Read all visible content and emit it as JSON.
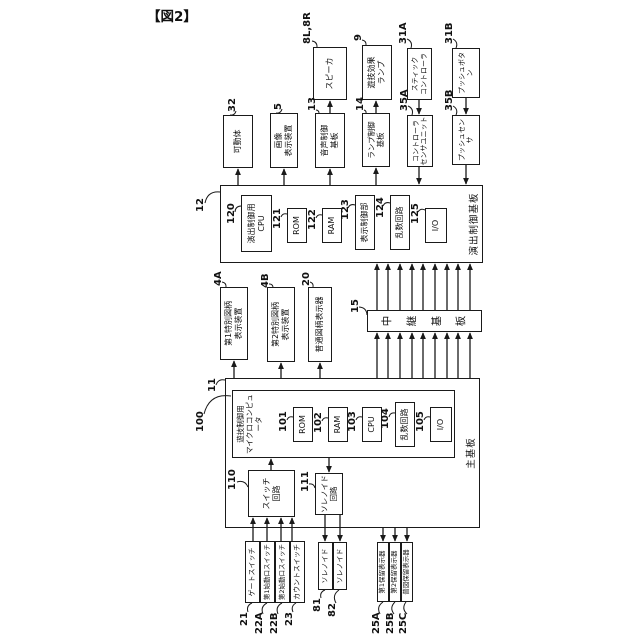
{
  "figure_label": "【図2】",
  "diagram": {
    "canvas": {
      "w": 630,
      "h": 292,
      "left": 195,
      "top": 8
    },
    "line_color": "#1a1a1a",
    "boxes": [
      {
        "id": "production-control-board",
        "x": 375,
        "y": 25,
        "w": 78,
        "h": 263,
        "lines": [
          "演出制御基板"
        ],
        "container": true,
        "label_pos": "bottom"
      },
      {
        "id": "main-board",
        "x": 110,
        "y": 30,
        "w": 150,
        "h": 255,
        "lines": [
          "主基板"
        ],
        "container": true,
        "label_pos": "bottom"
      },
      {
        "id": "game-control-micom",
        "x": 180,
        "y": 37,
        "w": 68,
        "h": 223,
        "lines": [
          "遊技制御用",
          "マイクロコンピュータ"
        ],
        "container": true,
        "label_pos": "top",
        "fs": 7.5
      },
      {
        "id": "effect-cpu-120",
        "x": 386,
        "y": 46,
        "w": 57,
        "h": 31,
        "lines": [
          "演出制御用",
          "CPU"
        ]
      },
      {
        "id": "rom-121",
        "x": 395,
        "y": 92,
        "w": 35,
        "h": 20,
        "lines": [
          "ROM"
        ]
      },
      {
        "id": "ram-122",
        "x": 395,
        "y": 127,
        "w": 35,
        "h": 20,
        "lines": [
          "RAM"
        ]
      },
      {
        "id": "display-control-123",
        "x": 388,
        "y": 160,
        "w": 55,
        "h": 20,
        "lines": [
          "表示制御部"
        ]
      },
      {
        "id": "random-circuit-124",
        "x": 388,
        "y": 195,
        "w": 55,
        "h": 20,
        "lines": [
          "乱数回路"
        ]
      },
      {
        "id": "io-125",
        "x": 395,
        "y": 230,
        "w": 35,
        "h": 22,
        "lines": [
          "I/O"
        ]
      },
      {
        "id": "relay-board-15",
        "x": 306,
        "y": 172,
        "w": 22,
        "h": 115,
        "lines": [
          "中継基板"
        ],
        "vertical": true
      },
      {
        "id": "rom-101",
        "x": 196,
        "y": 98,
        "w": 35,
        "h": 20,
        "lines": [
          "ROM"
        ]
      },
      {
        "id": "ram-102",
        "x": 196,
        "y": 133,
        "w": 35,
        "h": 20,
        "lines": [
          "RAM"
        ]
      },
      {
        "id": "cpu-103",
        "x": 196,
        "y": 167,
        "w": 35,
        "h": 20,
        "lines": [
          "CPU"
        ]
      },
      {
        "id": "random-circuit-104",
        "x": 191,
        "y": 200,
        "w": 45,
        "h": 20,
        "lines": [
          "乱数回路"
        ]
      },
      {
        "id": "io-105",
        "x": 196,
        "y": 235,
        "w": 35,
        "h": 22,
        "lines": [
          "I/O"
        ]
      },
      {
        "id": "switch-circuit-110",
        "x": 121,
        "y": 53,
        "w": 47,
        "h": 47,
        "lines": [
          "スイッチ",
          "回路"
        ]
      },
      {
        "id": "solenoid-circuit-111",
        "x": 123,
        "y": 120,
        "w": 42,
        "h": 28,
        "lines": [
          "ソレノイド",
          "回路"
        ],
        "fs": 7.5
      },
      {
        "id": "movable-body-32",
        "x": 470,
        "y": 28,
        "w": 53,
        "h": 30,
        "lines": [
          "可動体"
        ]
      },
      {
        "id": "image-display-5",
        "x": 470,
        "y": 75,
        "w": 55,
        "h": 28,
        "lines": [
          "画像",
          "表示装置"
        ]
      },
      {
        "id": "sound-control-board-13",
        "x": 470,
        "y": 120,
        "w": 55,
        "h": 30,
        "lines": [
          "音声制御",
          "基板"
        ]
      },
      {
        "id": "lamp-control-board-14",
        "x": 471,
        "y": 167,
        "w": 54,
        "h": 28,
        "lines": [
          "ランプ制御",
          "基板"
        ],
        "fs": 7.5
      },
      {
        "id": "controller-sensor-unit-35a",
        "x": 471,
        "y": 212,
        "w": 52,
        "h": 26,
        "lines": [
          "コントローラ",
          "センサユニット"
        ],
        "fs": 7
      },
      {
        "id": "push-sensor-35b",
        "x": 473,
        "y": 257,
        "w": 50,
        "h": 28,
        "lines": [
          "プッシュセンサ"
        ],
        "fs": 7
      },
      {
        "id": "speaker-8",
        "x": 538,
        "y": 118,
        "w": 53,
        "h": 34,
        "lines": [
          "スピーカ"
        ]
      },
      {
        "id": "game-effect-lamp-9",
        "x": 538,
        "y": 167,
        "w": 55,
        "h": 30,
        "lines": [
          "遊技効果",
          "ランプ"
        ]
      },
      {
        "id": "stick-controller-31a",
        "x": 538,
        "y": 212,
        "w": 52,
        "h": 25,
        "lines": [
          "スティック",
          "コントローラ"
        ],
        "fs": 7
      },
      {
        "id": "push-button-31b",
        "x": 540,
        "y": 257,
        "w": 50,
        "h": 28,
        "lines": [
          "プッシュボタン"
        ],
        "fs": 7
      },
      {
        "id": "special-symbol-display-4a",
        "x": 278,
        "y": 25,
        "w": 73,
        "h": 28,
        "lines": [
          "第1特別図柄",
          "表示装置"
        ]
      },
      {
        "id": "special-symbol-display-4b",
        "x": 276,
        "y": 72,
        "w": 75,
        "h": 28,
        "lines": [
          "第2特別図柄",
          "表示装置"
        ]
      },
      {
        "id": "normal-symbol-display-20",
        "x": 276,
        "y": 113,
        "w": 75,
        "h": 24,
        "lines": [
          "普通図柄表示器"
        ]
      },
      {
        "id": "gate-switch-21",
        "x": 35,
        "y": 50,
        "w": 62,
        "h": 15,
        "lines": [
          "ゲートスイッチ"
        ],
        "fs": 7
      },
      {
        "id": "first-start-switch-22a",
        "x": 35,
        "y": 65,
        "w": 62,
        "h": 15,
        "lines": [
          "第1始動口スイッチ"
        ],
        "fs": 6.5
      },
      {
        "id": "second-start-switch-22b",
        "x": 35,
        "y": 80,
        "w": 62,
        "h": 15,
        "lines": [
          "第2始動口スイッチ"
        ],
        "fs": 6.5
      },
      {
        "id": "count-switch-23",
        "x": 35,
        "y": 95,
        "w": 62,
        "h": 15,
        "lines": [
          "カウントスイッチ"
        ],
        "fs": 7
      },
      {
        "id": "solenoid-81",
        "x": 48,
        "y": 123,
        "w": 48,
        "h": 15,
        "lines": [
          "ソレノイド"
        ],
        "fs": 7
      },
      {
        "id": "solenoid-82",
        "x": 48,
        "y": 138,
        "w": 48,
        "h": 14,
        "lines": [
          "ソレノイド"
        ],
        "fs": 7
      },
      {
        "id": "first-hold-display-25a",
        "x": 36,
        "y": 182,
        "w": 60,
        "h": 12,
        "lines": [
          "第1保留表示器"
        ],
        "fs": 6.5
      },
      {
        "id": "second-hold-display-25b",
        "x": 36,
        "y": 194,
        "w": 60,
        "h": 12,
        "lines": [
          "第2保留表示器"
        ],
        "fs": 6.5
      },
      {
        "id": "normal-hold-display-25c",
        "x": 36,
        "y": 206,
        "w": 60,
        "h": 12,
        "lines": [
          "普図保留表示器"
        ],
        "fs": 6.5
      }
    ],
    "labels": [
      {
        "t": "12",
        "x": 426,
        "y": 0,
        "lead": [
          435,
          10,
          446,
          25
        ]
      },
      {
        "t": "11",
        "x": 246,
        "y": 12,
        "lead": [
          253,
          21,
          258,
          30
        ]
      },
      {
        "t": "100",
        "x": 206,
        "y": 0,
        "lead": [
          224,
          9,
          242,
          36
        ]
      },
      {
        "t": "15",
        "x": 325,
        "y": 155,
        "lead": [
          331,
          164,
          323,
          172
        ]
      },
      {
        "t": "120",
        "x": 414,
        "y": 31,
        "lead": [
          426,
          40,
          432,
          46
        ]
      },
      {
        "t": "121",
        "x": 409,
        "y": 77,
        "lead": [
          421,
          86,
          424,
          92
        ]
      },
      {
        "t": "122",
        "x": 408,
        "y": 112,
        "lead": [
          420,
          121,
          423,
          127
        ]
      },
      {
        "t": "123",
        "x": 418,
        "y": 145,
        "lead": [
          430,
          153,
          433,
          160
        ]
      },
      {
        "t": "124",
        "x": 420,
        "y": 180,
        "lead": [
          432,
          188,
          435,
          195
        ]
      },
      {
        "t": "125",
        "x": 414,
        "y": 215,
        "lead": [
          426,
          223,
          428,
          230
        ]
      },
      {
        "t": "101",
        "x": 206,
        "y": 83,
        "lead": [
          218,
          92,
          221,
          98
        ]
      },
      {
        "t": "102",
        "x": 205,
        "y": 118,
        "lead": [
          217,
          127,
          220,
          133
        ]
      },
      {
        "t": "103",
        "x": 206,
        "y": 152,
        "lead": [
          218,
          161,
          221,
          167
        ]
      },
      {
        "t": "104",
        "x": 209,
        "y": 185,
        "lead": [
          221,
          194,
          225,
          200
        ]
      },
      {
        "t": "105",
        "x": 206,
        "y": 220,
        "lead": [
          218,
          229,
          221,
          235
        ]
      },
      {
        "t": "110",
        "x": 148,
        "y": 32,
        "lead": [
          156,
          42,
          151,
          53
        ]
      },
      {
        "t": "111",
        "x": 146,
        "y": 105,
        "lead": [
          154,
          114,
          150,
          120
        ]
      },
      {
        "t": "32",
        "x": 526,
        "y": 32,
        "lead": [
          527,
          41,
          523,
          35
        ]
      },
      {
        "t": "5",
        "x": 528,
        "y": 78,
        "lead": [
          529,
          87,
          525,
          81
        ]
      },
      {
        "t": "13",
        "x": 527,
        "y": 112,
        "lead": [
          528,
          121,
          525,
          124
        ]
      },
      {
        "t": "14",
        "x": 527,
        "y": 160,
        "lead": [
          528,
          169,
          525,
          171
        ]
      },
      {
        "t": "35A",
        "x": 527,
        "y": 204,
        "lead": [
          532,
          213,
          523,
          217
        ]
      },
      {
        "t": "35B",
        "x": 527,
        "y": 249,
        "lead": [
          532,
          258,
          523,
          261
        ]
      },
      {
        "t": "8L,8R",
        "x": 594,
        "y": 107,
        "lead": [
          597,
          117,
          591,
          122
        ]
      },
      {
        "t": "9",
        "x": 597,
        "y": 158,
        "lead": [
          598,
          167,
          593,
          171
        ]
      },
      {
        "t": "31A",
        "x": 594,
        "y": 203,
        "lead": [
          599,
          212,
          590,
          216
        ]
      },
      {
        "t": "31B",
        "x": 594,
        "y": 249,
        "lead": [
          599,
          258,
          590,
          261
        ]
      },
      {
        "t": "4A",
        "x": 352,
        "y": 18,
        "lead": [
          356,
          27,
          351,
          31
        ]
      },
      {
        "t": "4B",
        "x": 350,
        "y": 65,
        "lead": [
          354,
          74,
          351,
          78
        ]
      },
      {
        "t": "20",
        "x": 352,
        "y": 106,
        "lead": [
          356,
          115,
          351,
          118
        ]
      },
      {
        "t": "21",
        "x": 12,
        "y": 44,
        "lead": [
          26,
          53,
          35,
          57
        ]
      },
      {
        "t": "22A",
        "x": 4,
        "y": 59,
        "lead": [
          24,
          68,
          35,
          72
        ]
      },
      {
        "t": "22B",
        "x": 4,
        "y": 74,
        "lead": [
          24,
          83,
          35,
          87
        ]
      },
      {
        "t": "23",
        "x": 12,
        "y": 89,
        "lead": [
          26,
          98,
          35,
          101
        ]
      },
      {
        "t": "81",
        "x": 26,
        "y": 117,
        "lead": [
          40,
          126,
          48,
          130
        ]
      },
      {
        "t": "82",
        "x": 21,
        "y": 132,
        "lead": [
          35,
          141,
          48,
          144
        ]
      },
      {
        "t": "25A",
        "x": 4,
        "y": 176,
        "lead": [
          24,
          185,
          36,
          188
        ]
      },
      {
        "t": "25B",
        "x": 4,
        "y": 190,
        "lead": [
          24,
          199,
          36,
          200
        ]
      },
      {
        "t": "25C",
        "x": 4,
        "y": 203,
        "lead": [
          24,
          212,
          36,
          211
        ]
      }
    ],
    "arrows": [
      [
        453,
        43,
        469,
        43
      ],
      [
        453,
        89,
        469,
        89
      ],
      [
        453,
        135,
        469,
        135
      ],
      [
        453,
        181,
        470,
        181
      ],
      [
        525,
        135,
        537,
        135
      ],
      [
        525,
        181,
        537,
        181
      ],
      [
        538,
        224,
        524,
        224
      ],
      [
        471,
        224,
        454,
        224
      ],
      [
        540,
        271,
        524,
        271
      ],
      [
        473,
        271,
        454,
        271
      ],
      [
        260,
        39,
        277,
        39
      ],
      [
        260,
        86,
        275,
        86
      ],
      [
        260,
        125,
        275,
        125
      ],
      [
        260,
        182,
        305,
        182
      ],
      [
        328,
        182,
        374,
        182
      ],
      [
        260,
        193,
        305,
        193
      ],
      [
        328,
        193,
        374,
        193
      ],
      [
        260,
        205,
        305,
        205
      ],
      [
        328,
        205,
        374,
        205
      ],
      [
        260,
        217,
        305,
        217
      ],
      [
        328,
        217,
        374,
        217
      ],
      [
        260,
        228,
        305,
        228
      ],
      [
        328,
        228,
        374,
        228
      ],
      [
        260,
        240,
        305,
        240
      ],
      [
        328,
        240,
        374,
        240
      ],
      [
        260,
        252,
        305,
        252
      ],
      [
        328,
        252,
        374,
        252
      ],
      [
        260,
        263,
        305,
        263
      ],
      [
        328,
        263,
        374,
        263
      ],
      [
        260,
        275,
        305,
        275
      ],
      [
        328,
        275,
        374,
        275
      ],
      [
        168,
        76,
        179,
        76
      ],
      [
        180,
        134,
        166,
        134
      ],
      [
        97,
        58,
        120,
        58
      ],
      [
        97,
        72,
        120,
        72
      ],
      [
        97,
        86,
        120,
        86
      ],
      [
        97,
        97,
        120,
        97
      ],
      [
        123,
        130,
        97,
        130
      ],
      [
        123,
        145,
        97,
        145
      ],
      [
        110,
        188,
        97,
        188
      ],
      [
        110,
        200,
        97,
        200
      ],
      [
        110,
        212,
        97,
        212
      ]
    ]
  }
}
